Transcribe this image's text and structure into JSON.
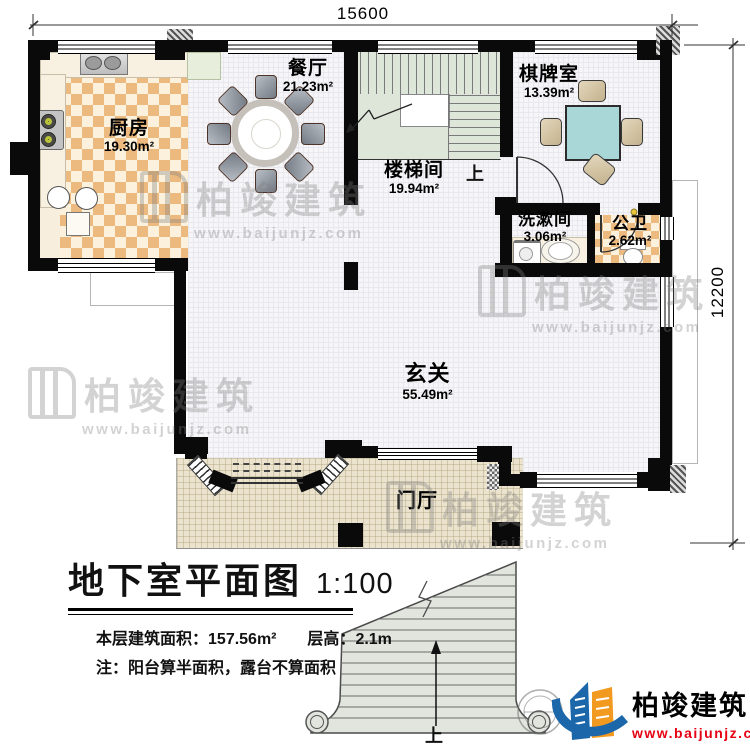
{
  "dimensions": {
    "top": "15600",
    "right": "12200"
  },
  "watermark": {
    "brand": "柏竣建筑",
    "url": "www.baijunjz.com"
  },
  "rooms": {
    "kitchen": {
      "name": "厨房",
      "area": "19.30m²"
    },
    "dining": {
      "name": "餐厅",
      "area": "21.23m²"
    },
    "stairwell": {
      "name": "楼梯间",
      "area": "19.94m²",
      "direction": "上"
    },
    "chess": {
      "name": "棋牌室",
      "area": "13.39m²"
    },
    "washroom": {
      "name": "洗漱间",
      "area": "3.06m²"
    },
    "wc": {
      "name": "公卫",
      "area": "2.62m²"
    },
    "hall": {
      "name": "玄关",
      "area": "55.49m²"
    },
    "porch": {
      "name": "门厅"
    }
  },
  "outdoor_stair": {
    "direction": "上"
  },
  "title_block": {
    "title": "地下室平面图",
    "scale": "1:100",
    "floor_area_label": "本层建筑面积：",
    "floor_area": "157.56m²",
    "story_height_label": "层高：",
    "story_height": "2.1m",
    "note": "注：阳台算半面积，露台不算面积"
  },
  "logo": {
    "brand": "柏竣建筑",
    "url": "www.baijunjz.com"
  }
}
